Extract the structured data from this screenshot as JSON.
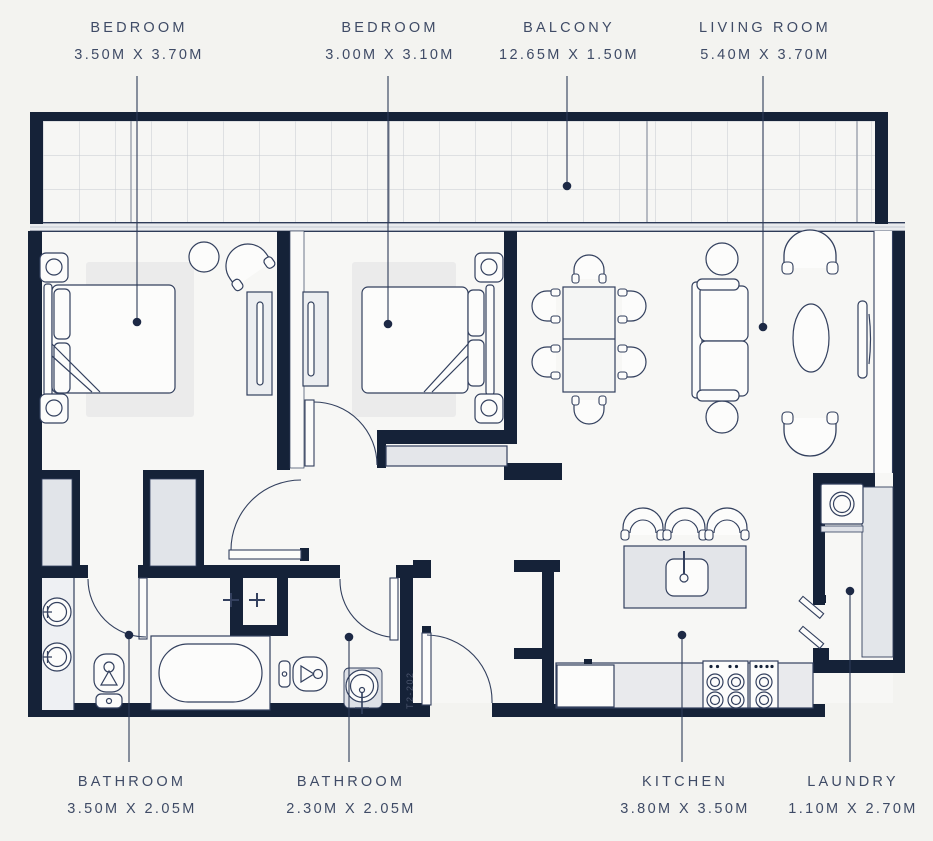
{
  "plan": {
    "unit_number": "T2-202",
    "colors": {
      "wall": "#152238",
      "leader": "#2e3b58",
      "label_text": "#3f4b66",
      "furniture_line": "#33405e",
      "floor": "#f7f7f5",
      "light_fill": "#e3e6ea",
      "page_background": "#f3f3f0"
    },
    "rooms": [
      {
        "id": "bedroom-1",
        "name": "BEDROOM",
        "dims": "3.50M X 3.70M",
        "label_side": "top"
      },
      {
        "id": "bedroom-2",
        "name": "BEDROOM",
        "dims": "3.00M X 3.10M",
        "label_side": "top"
      },
      {
        "id": "balcony",
        "name": "BALCONY",
        "dims": "12.65M X 1.50M",
        "label_side": "top"
      },
      {
        "id": "living-room",
        "name": "LIVING ROOM",
        "dims": "5.40M X 3.70M",
        "label_side": "top"
      },
      {
        "id": "bathroom-1",
        "name": "BATHROOM",
        "dims": "3.50M X 2.05M",
        "label_side": "bottom"
      },
      {
        "id": "bathroom-2",
        "name": "BATHROOM",
        "dims": "2.30M X 2.05M",
        "label_side": "bottom"
      },
      {
        "id": "kitchen",
        "name": "KITCHEN",
        "dims": "3.80M X 3.50M",
        "label_side": "bottom"
      },
      {
        "id": "laundry",
        "name": "LAUNDRY",
        "dims": "1.10M X 2.70M",
        "label_side": "bottom"
      }
    ]
  }
}
